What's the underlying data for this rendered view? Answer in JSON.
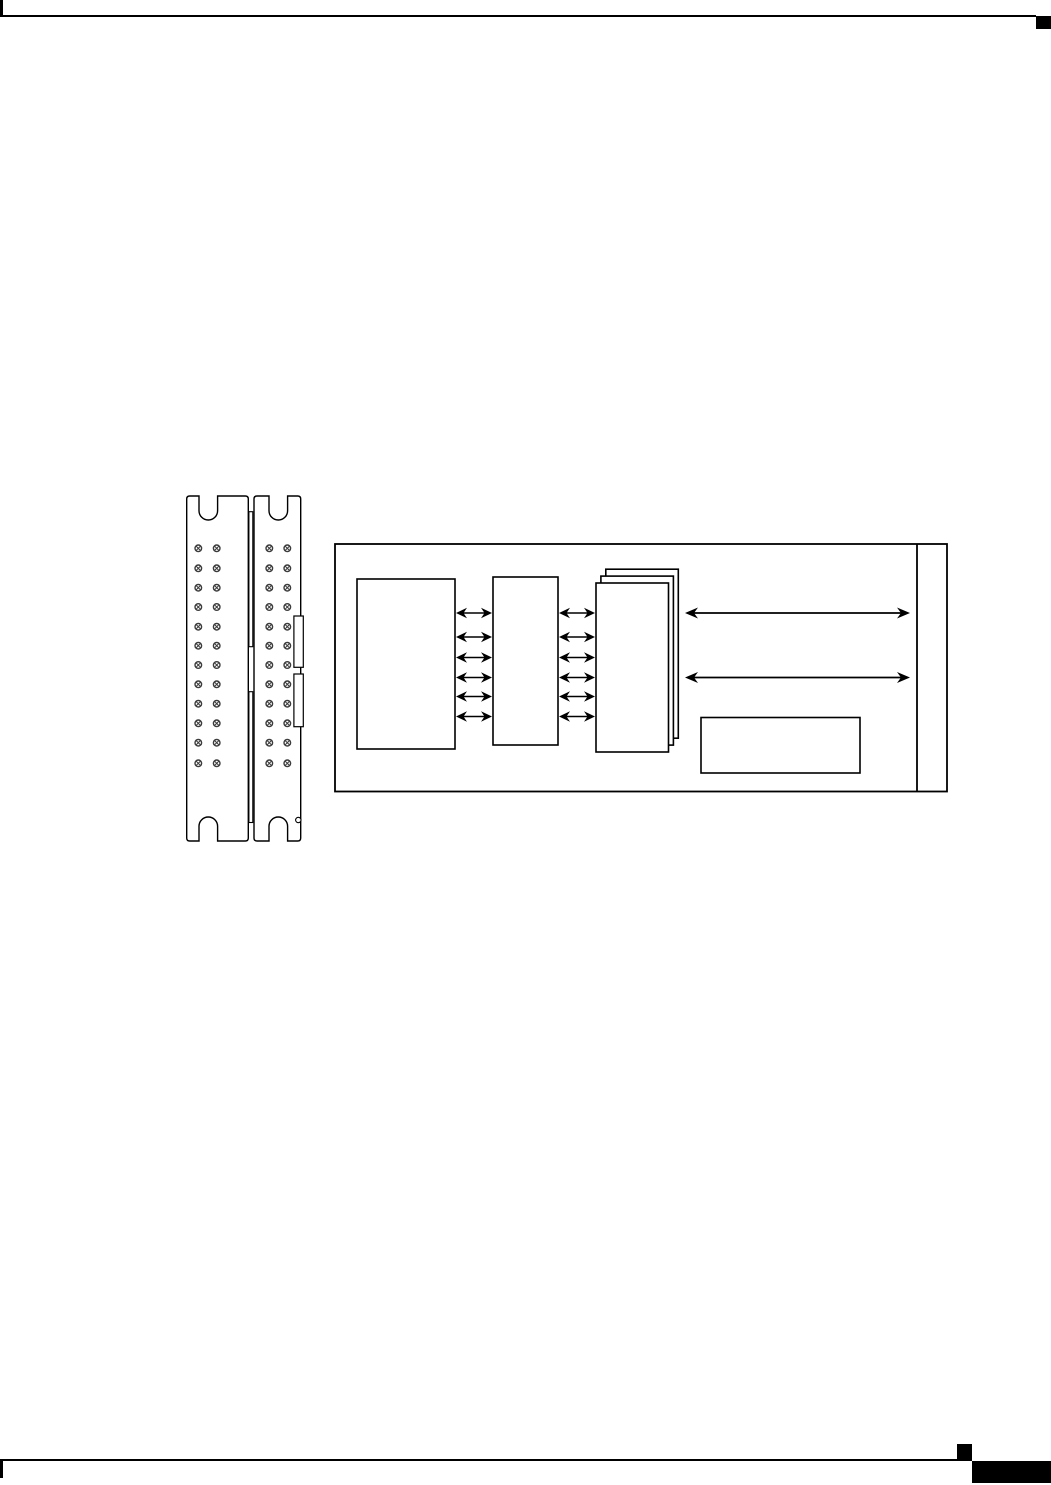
{
  "page": {
    "width": 1051,
    "height": 1485,
    "background": "#ffffff",
    "ink": "#000000",
    "screw_ink": "#3c3c3c",
    "content_note": "Blank manual page containing two unlabeled figure drawings: a dual screw-terminal faceplate and a module block diagram. No visible text anywhere on the page."
  },
  "page_marks": [
    {
      "name": "header-left-crop-mark",
      "x": 0,
      "y": 0,
      "w": 3,
      "h": 15
    },
    {
      "name": "header-rule",
      "x": 0,
      "y": 15,
      "w": 1036,
      "h": 2
    },
    {
      "name": "chapter-tab-marker",
      "x": 1036,
      "y": 16,
      "w": 15,
      "h": 13
    },
    {
      "name": "footer-rule",
      "x": 0,
      "y": 1459,
      "w": 972,
      "h": 2
    },
    {
      "name": "footer-left-crop-mark",
      "x": 0,
      "y": 1460,
      "w": 3,
      "h": 18
    },
    {
      "name": "footer-page-marker",
      "x": 957,
      "y": 1444,
      "w": 15,
      "h": 16
    },
    {
      "name": "footer-corner-block",
      "x": 972,
      "y": 1461,
      "w": 79,
      "h": 22
    }
  ],
  "faceplate": {
    "stroke_w": 1.4,
    "plates": [
      {
        "x": 186.7,
        "y": 496,
        "w": 61.6,
        "h": 345,
        "notch_cx": 208.3,
        "screw_cols": [
          198.3,
          216.7
        ]
      },
      {
        "x": 254.0,
        "y": 496,
        "w": 46.7,
        "h": 345,
        "notch_cx": 278.3,
        "screw_cols": [
          269.3,
          287.3
        ]
      }
    ],
    "notch": {
      "half_w": 9.3,
      "depth": 24,
      "corner_r": 3
    },
    "screw_rows_y": [
      548.3,
      568.3,
      587.7,
      607,
      626.7,
      645.7,
      665,
      684.3,
      703.7,
      723.3,
      742.7,
      763.3
    ],
    "screw_style": {
      "r": 3.3,
      "cross_k": 2.3,
      "dot_r": 0.8,
      "ring_w": 1.4,
      "cross_w": 1.0
    },
    "strip": {
      "x": 248.9,
      "w": 3.9,
      "segments": [
        [
          511.7,
          646.7
        ],
        [
          691.7,
          822.5
        ]
      ],
      "stroke_w": 1.1
    },
    "slots": [
      {
        "x": 293.9,
        "y": 616.0,
        "w": 9.4,
        "h": 51.3
      },
      {
        "x": 293.9,
        "y": 674.0,
        "w": 9.4,
        "h": 52.7
      }
    ],
    "pin_hole": {
      "cx": 298.3,
      "cy": 820,
      "r": 2.7
    }
  },
  "block_diagram": {
    "outer": {
      "x": 335,
      "y": 544,
      "w": 612,
      "h": 247.5,
      "stroke_w": 1.8
    },
    "divider_x": 917,
    "box_stroke_w": 1.6,
    "left_box": {
      "x": 357,
      "y": 579,
      "w": 98,
      "h": 170
    },
    "middle_box": {
      "x": 493,
      "y": 577,
      "w": 65,
      "h": 168
    },
    "stack": {
      "x": 596,
      "y": 583,
      "w": 72.5,
      "h": 169,
      "count": 3,
      "dx": 4.9,
      "dy": -6.9
    },
    "small_box": {
      "x": 701,
      "y": 717.5,
      "w": 159,
      "h": 55.5
    },
    "arrow_rows_y": [
      613,
      637,
      657.5,
      677.5,
      696.5,
      716.5
    ],
    "arrow_groups": [
      {
        "x1": 456,
        "x2": 492
      },
      {
        "x1": 559,
        "x2": 595
      }
    ],
    "long_arrows": {
      "x1": 685,
      "x2": 910,
      "row_indices": [
        0,
        3
      ]
    },
    "arrow_style": {
      "head_len": 11,
      "head_half_w": 5.3,
      "barb": 3.5,
      "shaft_w": 1.6
    },
    "long_arrow_style": {
      "head_len": 13,
      "head_half_w": 5.5,
      "barb": 4.0,
      "shaft_w": 1.7
    }
  }
}
